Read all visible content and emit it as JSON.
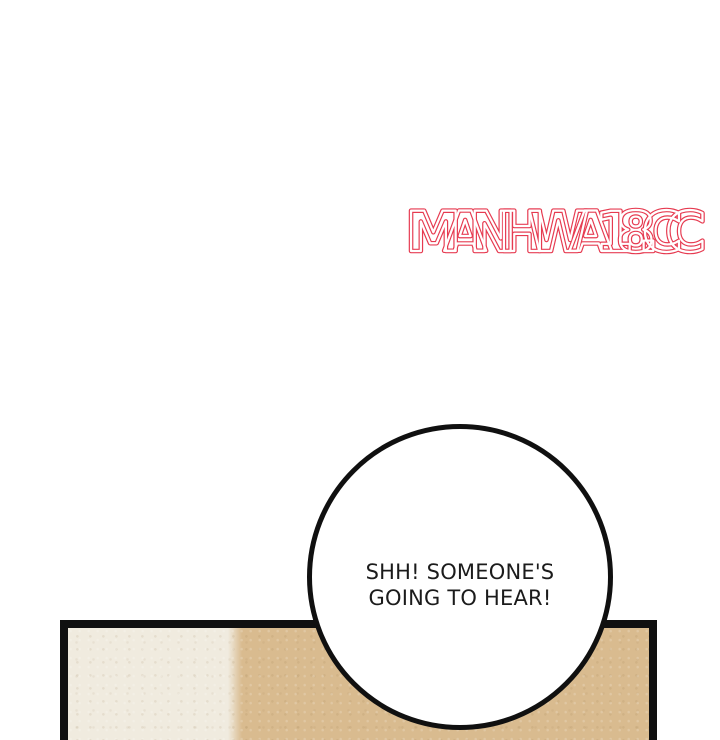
{
  "page": {
    "background": "#ffffff"
  },
  "watermark": {
    "text": "MANHWA18.CC",
    "color": "#e63a50"
  },
  "speech_bubble": {
    "line1": "SHH! SOMEONE'S",
    "line2": "GOING TO HEAR!",
    "fill": "#ffffff",
    "border_color": "#101010"
  },
  "panel": {
    "border_color": "#101010",
    "wall_left_color": "#f0ebdf",
    "wall_right_color": "#d9bb8f"
  }
}
